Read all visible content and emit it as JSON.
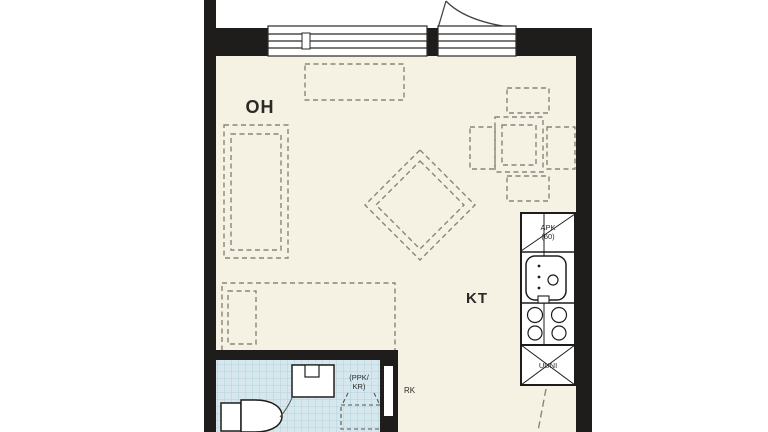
{
  "rooms": {
    "living": {
      "label": "OH"
    },
    "kitchen": {
      "label": "KT"
    }
  },
  "appliances": {
    "dishwasher": {
      "line1": "APK",
      "line2": "(60)"
    },
    "oven_cabinet": {
      "label": "UUNI"
    },
    "electrical_panel": {
      "label": "RK"
    },
    "laundry_reservation": {
      "line1": "(PPK/",
      "line2": "KR)"
    }
  },
  "colors": {
    "wall": "#1e1d1b",
    "floor": "#f6f2e3",
    "bathroom_tile": "#d6e8ed",
    "bathroom_tile_line": "#b3d2db",
    "furniture_dash": "#87867e",
    "label_text": "#2b2a27"
  }
}
